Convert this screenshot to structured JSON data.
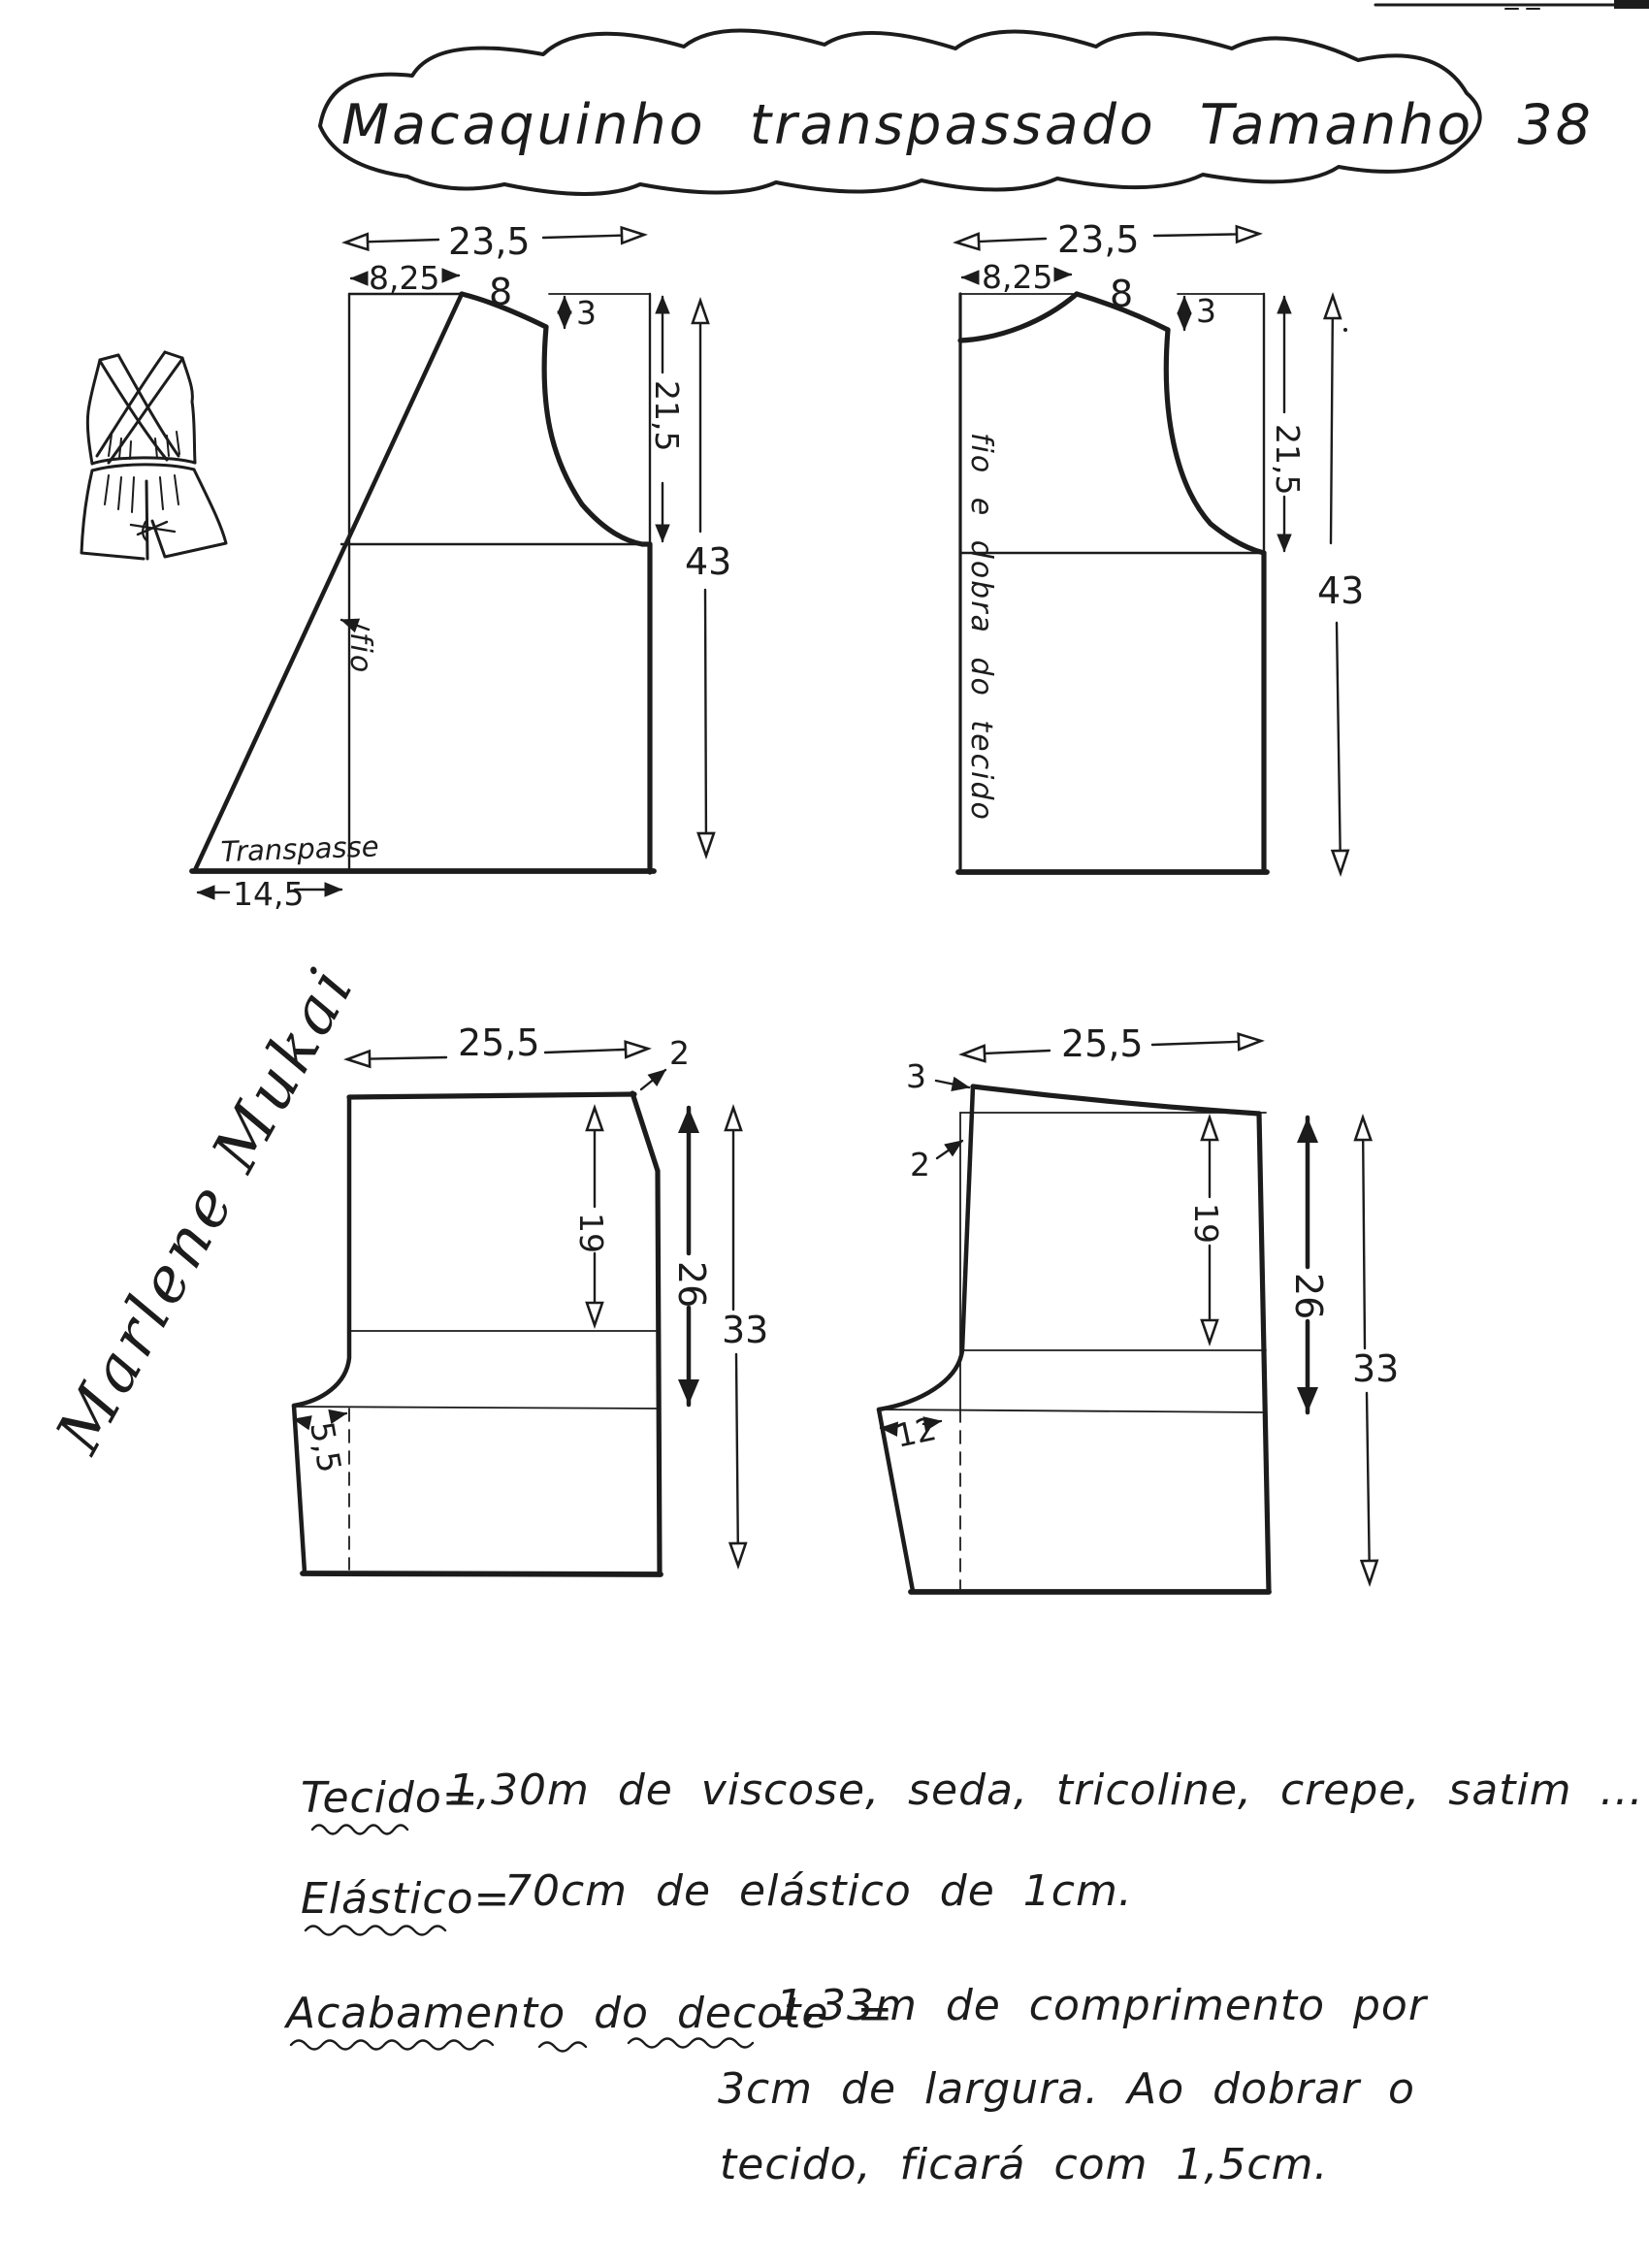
{
  "page": {
    "background": "#ffffff",
    "ink": "#1c1c1c"
  },
  "title": "Macaquinho transpassado Tamanho 38",
  "signature": "Marlene Mukai",
  "front_bodice": {
    "width": "23,5",
    "shoulder_offset": "8,25",
    "shoulder_len": "8",
    "shoulder_drop": "3",
    "armhole_depth": "21,5",
    "length": "43",
    "grain": "fio",
    "wrap": "Transpasse",
    "wrap_width": "14,5"
  },
  "back_bodice": {
    "width": "23,5",
    "shoulder_offset": "8,25",
    "shoulder_len": "8",
    "shoulder_drop": "3",
    "armhole_depth": "21,5",
    "length": "43",
    "grain": "fio e dobra do tecido"
  },
  "shorts_front": {
    "width": "25,5",
    "side_drop": "2",
    "hip_depth": "19",
    "crotch_depth": "26",
    "length": "33",
    "crotch_ext": "5,5"
  },
  "shorts_back": {
    "width": "25,5",
    "waist_raise": "3",
    "side_offset": "2",
    "hip_depth": "19",
    "crotch_depth": "26",
    "length": "33",
    "crotch_ext": "12"
  },
  "notes": {
    "fabric_label": "Tecido=",
    "fabric_text": "1,30m de viscose, seda, tricoline, crepe, satim ...",
    "elastic_label": "Elástico=",
    "elastic_text": "70cm de elástico de 1cm.",
    "neckline_label": "Acabamento do decote =",
    "neckline_line1": "1,33m de comprimento por",
    "neckline_line2": "3cm de largura. Ao dobrar o",
    "neckline_line3": "tecido, ficará com 1,5cm."
  }
}
